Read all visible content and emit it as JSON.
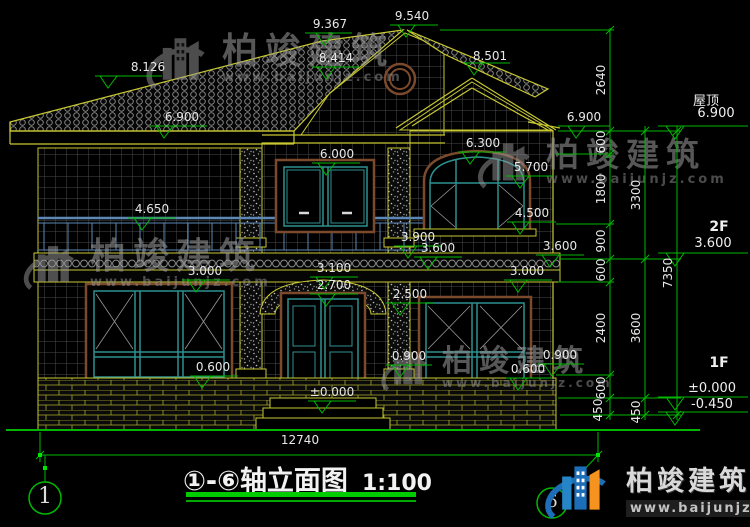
{
  "brand": {
    "name": "柏竣建筑",
    "url": "www.baijunjz.com"
  },
  "title": {
    "axes": "①-⑥",
    "name": "轴立面图",
    "scale": "1:100"
  },
  "axis_bubbles": {
    "left": "1",
    "right": "6"
  },
  "dims": {
    "total_width": "12740",
    "inner_chain": [
      "2640",
      "600",
      "1800",
      "900",
      "600",
      "2400",
      "600",
      "450"
    ],
    "middle_chain": [
      "3300",
      "3600",
      "450"
    ],
    "outer_chain": [
      "7350"
    ]
  },
  "levels": {
    "roof_label": "屋顶",
    "roof_value": "6.900",
    "f2_label": "2F",
    "f2_value": "3.600",
    "f1_label": "1F",
    "f1_zero": "±0.000",
    "f1_below": "-0.450"
  },
  "markers": [
    "9.367",
    "9.540",
    "8.501",
    "8.126",
    "8.414",
    "6.900",
    "6.900",
    "6.000",
    "6.300",
    "5.700",
    "4.650",
    "4.500",
    "3.900",
    "3.600",
    "3.600",
    "3.000",
    "3.000",
    "3.100",
    "2.700",
    "2.500",
    "0.600",
    "0.900",
    "0.600",
    "0.900",
    "±0.000"
  ]
}
